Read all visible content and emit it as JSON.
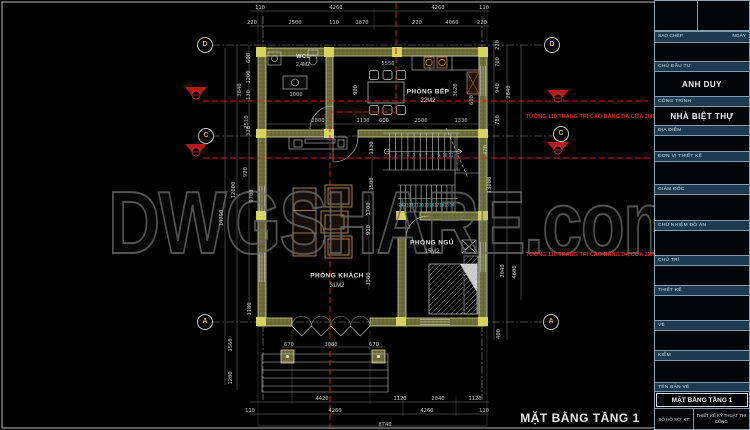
{
  "sheet": {
    "watermark": "DWGSHARE.com",
    "drawing_title": "MẶT BẰNG TẦNG 1"
  },
  "colors": {
    "background": "#000000",
    "wall_fill": "#6b6b37",
    "wall_edge": "#d6d68c",
    "column": "#d4d45e",
    "line": "#c8c8c8",
    "dim_text": "#c4c4c4",
    "section_red": "#d42020",
    "stair_number_cyan": "#35d8d8",
    "furniture_tan": "#c89a64",
    "titleblock_bar": "#1d3b50",
    "titleblock_border": "#7e9cb4"
  },
  "rooms": [
    {
      "name": "WC1",
      "area": "2,4M2"
    },
    {
      "name": "PHÒNG BẾP",
      "area": "22M2"
    },
    {
      "name": "PHÒNG KHÁCH",
      "area": "31M2"
    },
    {
      "name": "PHÒNG NGỦ",
      "area": "15M2"
    }
  ],
  "annotations": {
    "wall_note_1": "TƯỜNG 110 TRANG TRÍ CAO BẰNG DẠ CỬA 2M87",
    "wall_note_2": "TƯỜNG 110 TRANG TRÍ CAO BẰNG DẠ CỬA 2M87"
  },
  "grid_bubbles": [
    {
      "label": "D",
      "x": 205,
      "y": 45
    },
    {
      "label": "C",
      "x": 206,
      "y": 136
    },
    {
      "label": "A",
      "x": 205,
      "y": 322
    },
    {
      "label": "D",
      "x": 552,
      "y": 45
    },
    {
      "label": "C",
      "x": 561,
      "y": 134
    },
    {
      "label": "A",
      "x": 551,
      "y": 322
    }
  ],
  "stairs": {
    "run1_numbers": [
      "1",
      "2",
      "3",
      "4",
      "5",
      "6",
      "7",
      "8",
      "9",
      "10",
      "11"
    ],
    "run2_numbers": [
      "24",
      "23",
      "22",
      "21",
      "20",
      "19",
      "18",
      "17",
      "16",
      "15",
      "14"
    ]
  },
  "dimensions": {
    "labels": [
      {
        "t": "110",
        "x": 260,
        "y": 8
      },
      {
        "t": "4260",
        "x": 336,
        "y": 8
      },
      {
        "t": "4260",
        "x": 438,
        "y": 8
      },
      {
        "t": "110",
        "x": 484,
        "y": 8
      },
      {
        "t": "220",
        "x": 252,
        "y": 23
      },
      {
        "t": "2500",
        "x": 295,
        "y": 23
      },
      {
        "t": "110",
        "x": 334,
        "y": 23
      },
      {
        "t": "1870",
        "x": 362,
        "y": 23
      },
      {
        "t": "220",
        "x": 417,
        "y": 23
      },
      {
        "t": "4060",
        "x": 452,
        "y": 23
      },
      {
        "t": "220",
        "x": 482,
        "y": 23
      },
      {
        "t": "5550",
        "x": 388,
        "y": 64
      },
      {
        "t": "900",
        "x": 356,
        "y": 90,
        "r": 1
      },
      {
        "t": "3620",
        "x": 456,
        "y": 90,
        "r": 1
      },
      {
        "t": "600",
        "x": 472,
        "y": 100,
        "r": 1
      },
      {
        "t": "1000",
        "x": 296,
        "y": 95
      },
      {
        "t": "2800",
        "x": 318,
        "y": 121
      },
      {
        "t": "1130",
        "x": 363,
        "y": 121
      },
      {
        "t": "600",
        "x": 384,
        "y": 121
      },
      {
        "t": "2500",
        "x": 421,
        "y": 121
      },
      {
        "t": "1330",
        "x": 461,
        "y": 121
      },
      {
        "t": "1130",
        "x": 372,
        "y": 148,
        "r": 1
      },
      {
        "t": "1500",
        "x": 372,
        "y": 184,
        "r": 1
      },
      {
        "t": "420",
        "x": 486,
        "y": 150,
        "r": 1
      },
      {
        "t": "1700",
        "x": 369,
        "y": 209,
        "r": 1
      },
      {
        "t": "910",
        "x": 369,
        "y": 230,
        "r": 1
      },
      {
        "t": "3300",
        "x": 369,
        "y": 279,
        "r": 1
      },
      {
        "t": "670",
        "x": 289,
        "y": 345
      },
      {
        "t": "3080",
        "x": 331,
        "y": 345
      },
      {
        "t": "670",
        "x": 374,
        "y": 345
      },
      {
        "t": "4420",
        "x": 322,
        "y": 399
      },
      {
        "t": "1120",
        "x": 400,
        "y": 399
      },
      {
        "t": "2040",
        "x": 438,
        "y": 399
      },
      {
        "t": "1120",
        "x": 475,
        "y": 399
      },
      {
        "t": "110",
        "x": 250,
        "y": 411
      },
      {
        "t": "4260",
        "x": 335,
        "y": 411
      },
      {
        "t": "4260",
        "x": 427,
        "y": 411
      },
      {
        "t": "110",
        "x": 484,
        "y": 411
      },
      {
        "t": "8740",
        "x": 385,
        "y": 425
      },
      {
        "t": "600",
        "x": 249,
        "y": 58,
        "r": 1
      },
      {
        "t": "1200",
        "x": 249,
        "y": 77,
        "r": 1
      },
      {
        "t": "130",
        "x": 249,
        "y": 95,
        "r": 1
      },
      {
        "t": "320",
        "x": 249,
        "y": 131,
        "r": 1
      },
      {
        "t": "3840",
        "x": 240,
        "y": 90,
        "r": 1
      },
      {
        "t": "2510",
        "x": 247,
        "y": 122,
        "r": 1
      },
      {
        "t": "920",
        "x": 246,
        "y": 172,
        "r": 1
      },
      {
        "t": "12000",
        "x": 234,
        "y": 190,
        "r": 1
      },
      {
        "t": "9700",
        "x": 252,
        "y": 196,
        "r": 1
      },
      {
        "t": "14790",
        "x": 222,
        "y": 218,
        "r": 1
      },
      {
        "t": "1180",
        "x": 250,
        "y": 309,
        "r": 1
      },
      {
        "t": "1560",
        "x": 231,
        "y": 345,
        "r": 1
      },
      {
        "t": "1200",
        "x": 231,
        "y": 378,
        "r": 1
      },
      {
        "t": "220",
        "x": 498,
        "y": 45,
        "r": 1
      },
      {
        "t": "700",
        "x": 498,
        "y": 62,
        "r": 1
      },
      {
        "t": "940",
        "x": 498,
        "y": 88,
        "r": 1
      },
      {
        "t": "2840",
        "x": 509,
        "y": 92,
        "r": 1
      },
      {
        "t": "780",
        "x": 498,
        "y": 120,
        "r": 1
      },
      {
        "t": "13000",
        "x": 490,
        "y": 185,
        "r": 1
      },
      {
        "t": "2040",
        "x": 503,
        "y": 271,
        "r": 1
      },
      {
        "t": "4600",
        "x": 515,
        "y": 272,
        "r": 1
      },
      {
        "t": "400",
        "x": 499,
        "y": 334,
        "r": 1
      }
    ]
  },
  "titleblock": {
    "rows": [
      {
        "kind": "split2",
        "h": 30
      },
      {
        "kind": "pairbar",
        "left": "SAO CHÉP",
        "right": "NGÀY",
        "h": 12
      },
      {
        "kind": "val",
        "text": "",
        "h": 18
      },
      {
        "kind": "bar",
        "label": "CHỦ ĐẦU TƯ",
        "h": 11
      },
      {
        "kind": "val",
        "text": "ANH DUY",
        "h": 24
      },
      {
        "kind": "bar",
        "label": "CÔNG TRÌNH",
        "h": 11
      },
      {
        "kind": "val",
        "text": "NHÀ BIỆT THỰ",
        "h": 18
      },
      {
        "kind": "bar",
        "label": "ĐỊA ĐIỂM",
        "h": 11
      },
      {
        "kind": "val",
        "text": "",
        "h": 15
      },
      {
        "kind": "bar",
        "label": "ĐƠN VỊ THIẾT KẾ",
        "h": 11
      },
      {
        "kind": "val",
        "text": "",
        "h": 22
      },
      {
        "kind": "bar",
        "label": "GIÁM ĐỐC",
        "h": 11
      },
      {
        "kind": "val",
        "text": "",
        "h": 25
      },
      {
        "kind": "bar",
        "label": "CHỦ NHIỆM ĐỒ ÁN",
        "h": 11
      },
      {
        "kind": "val",
        "text": "",
        "h": 24
      },
      {
        "kind": "bar",
        "label": "CHỦ TRÌ",
        "h": 11
      },
      {
        "kind": "val",
        "text": "",
        "h": 19
      },
      {
        "kind": "bar",
        "label": "THIẾT KẾ",
        "h": 11
      },
      {
        "kind": "val",
        "text": "",
        "h": 24
      },
      {
        "kind": "bar",
        "label": "VẼ",
        "h": 11
      },
      {
        "kind": "val",
        "text": "",
        "h": 19
      },
      {
        "kind": "bar",
        "label": "KIỂM",
        "h": 11
      },
      {
        "kind": "val",
        "text": "",
        "h": 21
      },
      {
        "kind": "bar",
        "label": "TÊN BẢN VẼ",
        "h": 10
      },
      {
        "kind": "valbox",
        "text": "MẶT BẰNG TẦNG 1",
        "h": 16
      },
      {
        "kind": "pair2",
        "left": "SỐ HỒ SƠ: KT",
        "right": "THIẾT KẾ KỸ THUẬT THI CÔNG",
        "h": 21
      }
    ]
  }
}
